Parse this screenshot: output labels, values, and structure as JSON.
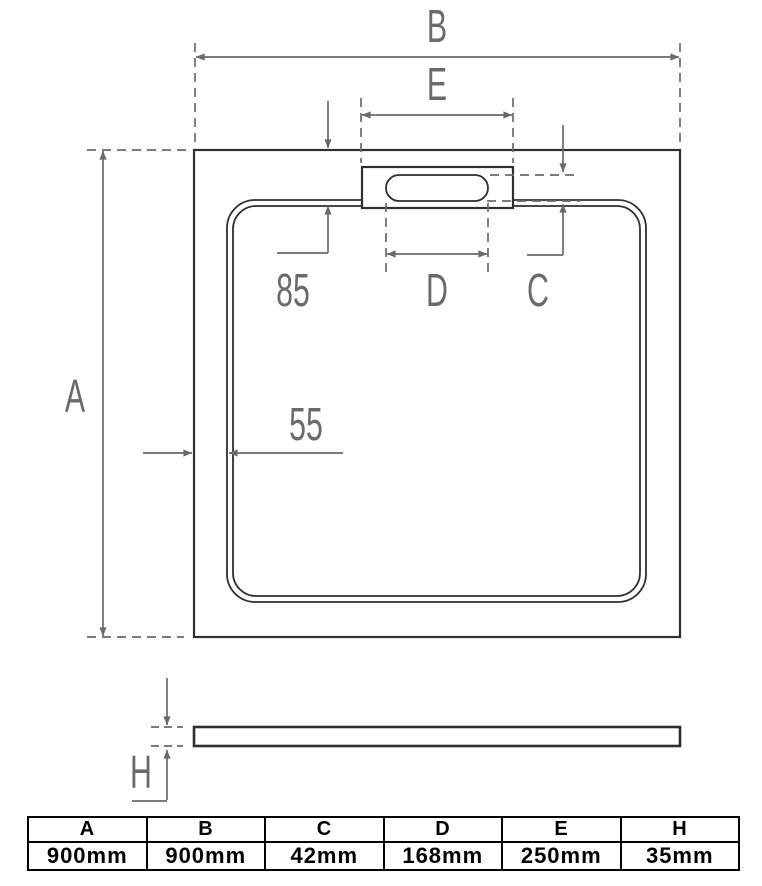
{
  "drawing": {
    "dim_labels": {
      "A": "A",
      "B": "B",
      "C": "C",
      "D": "D",
      "E": "E",
      "H": "H",
      "top_wall": "85",
      "side_wall": "55"
    }
  },
  "table": {
    "headers": [
      "A",
      "B",
      "C",
      "D",
      "E",
      "H"
    ],
    "values": [
      "900mm",
      "900mm",
      "42mm",
      "168mm",
      "250mm",
      "35mm"
    ]
  },
  "colors": {
    "outline": "#2f2f2f",
    "dimension": "#6a6a6a",
    "table": "#000000",
    "background": "#ffffff"
  }
}
